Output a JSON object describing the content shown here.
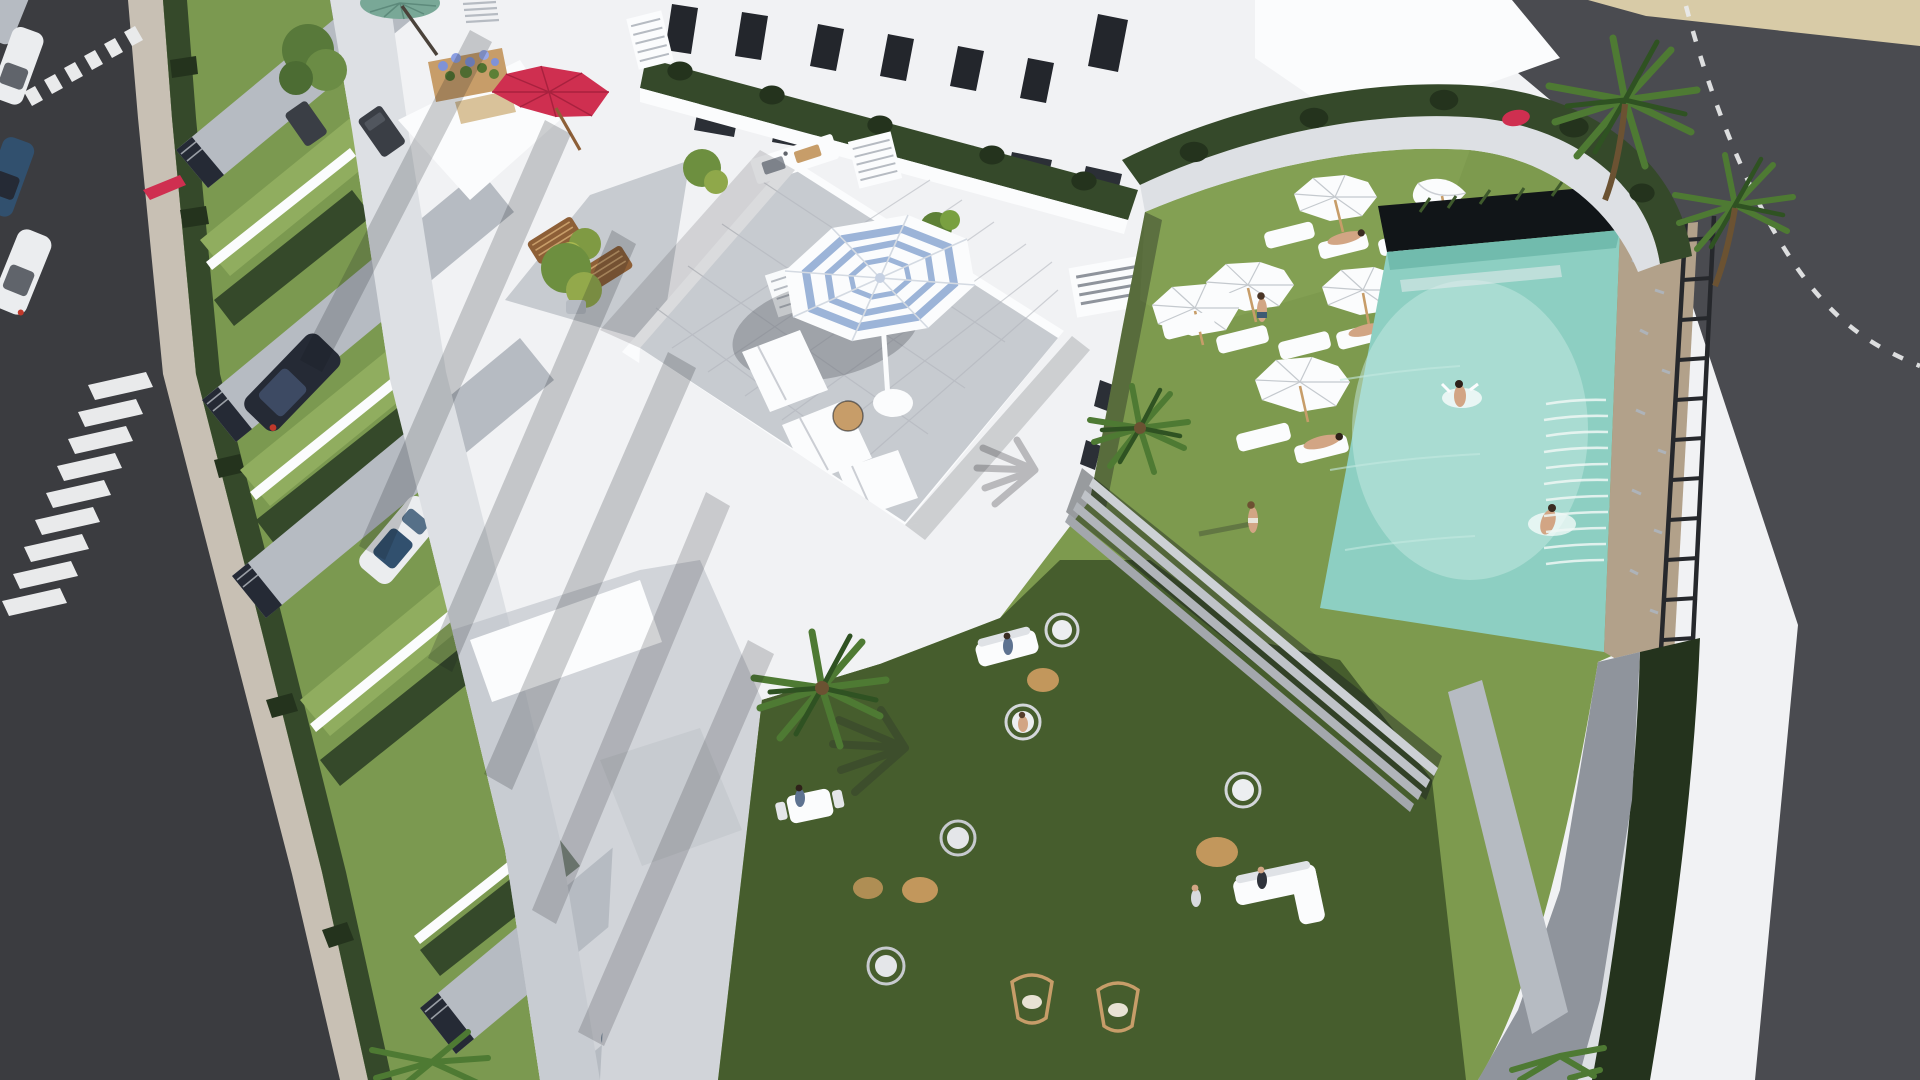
{
  "image": {
    "kind": "3d-architectural-render",
    "view": "aerial-oblique",
    "subject": "white residential apartment complex with rooftop terraces, street parking, communal garden and swimming pool"
  },
  "colors": {
    "asphalt": "#3b3c40",
    "asphalt_light": "#4a4b50",
    "marking": "#e9eaeb",
    "sidewalk": "#c8c0b4",
    "sand": "#d8cba7",
    "white": "#f1f2f4",
    "white_bright": "#fbfcfd",
    "wall_light": "#dde0e4",
    "wall_mid": "#b6bbc2",
    "wall_shade": "#8f949c",
    "facet_dark": "#60646b",
    "tile": "#c7cbd0",
    "tile_dark": "#aeb3b9",
    "hedge": "#35492a",
    "hedge_dark": "#24331d",
    "lawn": "#7b9950",
    "lawn_bright": "#90ad5f",
    "grass": "#7d9a4e",
    "grass_shadow": "#3c5228",
    "grass_olive": "#5c783d",
    "pool": "#8dcfc2",
    "pool_light": "#c5e9e1",
    "pool_deep": "#5fae9f",
    "stone": "#b2a18a",
    "stone_dark": "#8d7c66",
    "trellis": "#26282c",
    "wood": "#8d5f37",
    "wood_light": "#c79d69",
    "umbrella_red": "#cf2f50",
    "umbrella_green": "#79a897",
    "stripe_blue": "#9cb4d8",
    "skin": "#d2a584",
    "jute": "#c2975c",
    "car_dark": "#252a35",
    "car_white": "#ebedef",
    "car_blue": "#31506e",
    "car_gold": "#b18f3e",
    "palm_green": "#4e7a33",
    "palm_green_dark": "#2f5222",
    "shadow": "#14181e"
  },
  "scene": {
    "objects": [
      "street-with-crosswalks",
      "parked-cars",
      "pedestrians",
      "townhouse-front-yards",
      "driveway-gates",
      "gold-car",
      "dark-van",
      "white-car",
      "blue-car",
      "rooftop-terrace",
      "blue-striped-parasol",
      "sun-loungers",
      "wooden-deck-chairs",
      "outdoor-kitchen",
      "potted-plants",
      "red-parasol",
      "green-parasol",
      "flower-planter",
      "apartment-facade-windows",
      "balcony-hedges",
      "communal-garden",
      "white-garden-parasols",
      "sunbathers",
      "garden-stairs",
      "swimming-pool",
      "swimmers",
      "waterfall-wall",
      "stone-wall",
      "pergola-trellis",
      "perimeter-hedge-wall",
      "palm-trees",
      "hanging-egg-chairs",
      "jute-rugs",
      "outdoor-sofas",
      "swing-chairs",
      "beach-sand-strip",
      "dashed-road-line"
    ]
  }
}
